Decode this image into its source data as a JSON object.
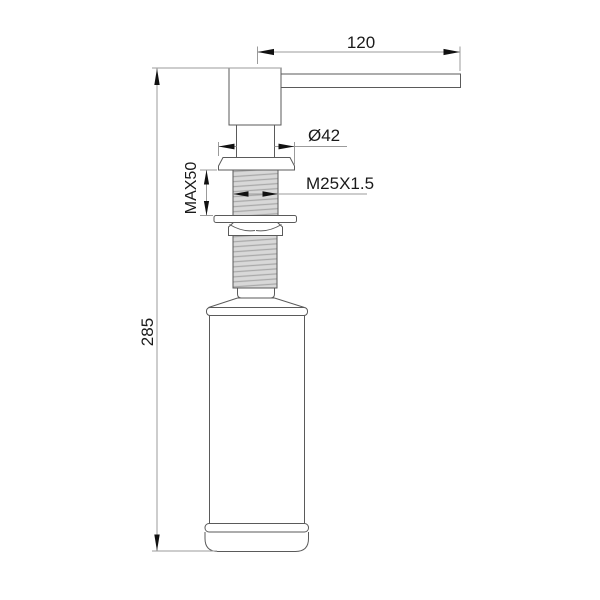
{
  "page": {
    "background": "#ffffff"
  },
  "drawing": {
    "type": "technical-drawing",
    "subject": "kitchen sink soap dispenser side elevation",
    "line_color": "#5a5a5a",
    "dim_line_color": "#9b9b9b",
    "arrow_color": "#111111",
    "text_color": "#1a1a1a",
    "thread_fill": "#d8d8d8",
    "thread_hatch_color": "#a9a9a9",
    "labels": {
      "spout_reach": "120",
      "flange_diameter": "Ø42",
      "max_counter_thickness": "MAX50",
      "thread_size": "M25X1.5",
      "overall_height": "285"
    }
  }
}
